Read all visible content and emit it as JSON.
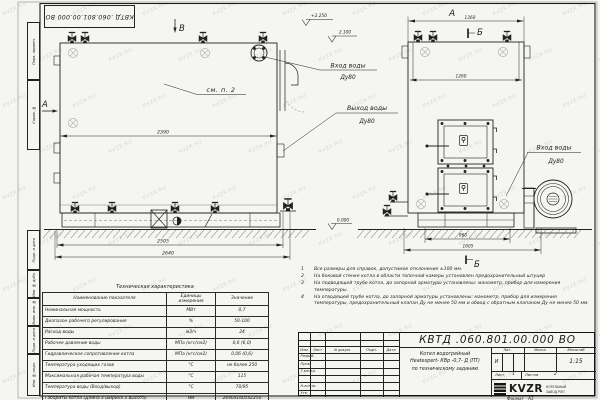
{
  "watermark": {
    "text": "KVZR.RU"
  },
  "stamp_top": {
    "doc_number": "КВТД .060.801.00.000  ВО"
  },
  "margin_fields": {
    "f0": "Перв. примен.",
    "f1": "Справ. №",
    "f2": "Подп. и дата",
    "f3": "Инв. № дубл.",
    "f4": "Взам. инв. №",
    "f5": "Подп. и дата",
    "f6": "Инв. № подл."
  },
  "drawing": {
    "view_b_label": "В",
    "view_a_arrow_label": "А",
    "view_a_title": "А",
    "section_b_top": "Б",
    "section_b_bottom": "Б",
    "note_ref": "см. п. 2",
    "dims": {
      "side_length": "2390",
      "side_base": "2505",
      "side_overall": "2640",
      "front_top": "1360",
      "front_inner": "1260",
      "front_base": "960",
      "front_overall": "1605"
    },
    "elevations": {
      "top": "+2.250",
      "mid": "2.100",
      "zero": "0.000"
    },
    "labels": {
      "inlet1": "Вход воды",
      "inlet1_dn": "Ду80",
      "outlet": "Выход воды",
      "outlet_dn": "Ду80",
      "inlet2": "Вход воды",
      "inlet2_dn": "Ду80"
    }
  },
  "table": {
    "title": "Техническая характеристика",
    "headers": [
      "Наименование показателя",
      "Единицы измерения",
      "Значение"
    ],
    "rows": [
      [
        "Номинальная мощность",
        "МВт",
        "0,7"
      ],
      [
        "Диапазон рабочего регулирования",
        "%",
        "50-100"
      ],
      [
        "Расход воды",
        "м3/ч",
        "24"
      ],
      [
        "Рабочее давление воды",
        "МПа (кгс/см2)",
        "0,6 (6,0)"
      ],
      [
        "Гидравлическое сопротивление котла",
        "МПа (кгс/см2)",
        "0,06 (0,6)"
      ],
      [
        "Температура уходящих газов",
        "°С",
        "не более 250"
      ],
      [
        "Максимальная рабочая температура воды",
        "°С",
        "115"
      ],
      [
        "Температура воды (Вход/выход)",
        "°С",
        "70/95"
      ],
      [
        "Габариты котла (Длина х ширина х высота)",
        "мм",
        "2640х1605х2250"
      ]
    ]
  },
  "notes": {
    "items": [
      {
        "num": "1",
        "text": "Все размеры для справок, допустимое отклонение ±100 мм."
      },
      {
        "num": "2",
        "text": "На боковой стенке котла в области топочной камеры установлен предохранительный штуцер"
      },
      {
        "num": "3",
        "text": "На подводящей трубе котла, до запорной арматуры установлены: манометр, прибор для измерения температуры."
      },
      {
        "num": "4",
        "text": "На отводящей трубе котла, до запорной арматуры установлены: манометр, прибор для измерения температуры, предохранительный клапан Ду не менее 50 мм и обвод с обратным клапаном Ду не менее 50 мм."
      }
    ]
  },
  "title_block": {
    "doc_number": "КВТД .060.801.00.000  ВО",
    "columns": [
      "Изм.",
      "Лист",
      "N докум.",
      "Подп.",
      "Дата"
    ],
    "rows": [
      "Разраб.",
      "Пров.",
      "Т.контр.",
      "",
      "Н.контр.",
      "Утв."
    ],
    "name_line1": "Котел водогрейный",
    "name_line2": "Heatexpert- КВр -0,7- Д (ПТ)",
    "name_line3": "по техническому заданию",
    "lit_header": "Лит.",
    "mass_header": "Масса",
    "scale_header": "Масштаб",
    "lit_value": "И",
    "scale_value": "1:15",
    "sheet_label": "Лист",
    "sheet_value": "1",
    "sheets_label": "Листов",
    "sheets_value": "2",
    "logo_text": "KVZR",
    "logo_line1": "КОТЕЛЬНЫЙ",
    "logo_line2": "ЗАВОД РЭП",
    "format_label": "Формат",
    "format_value": "А3"
  }
}
